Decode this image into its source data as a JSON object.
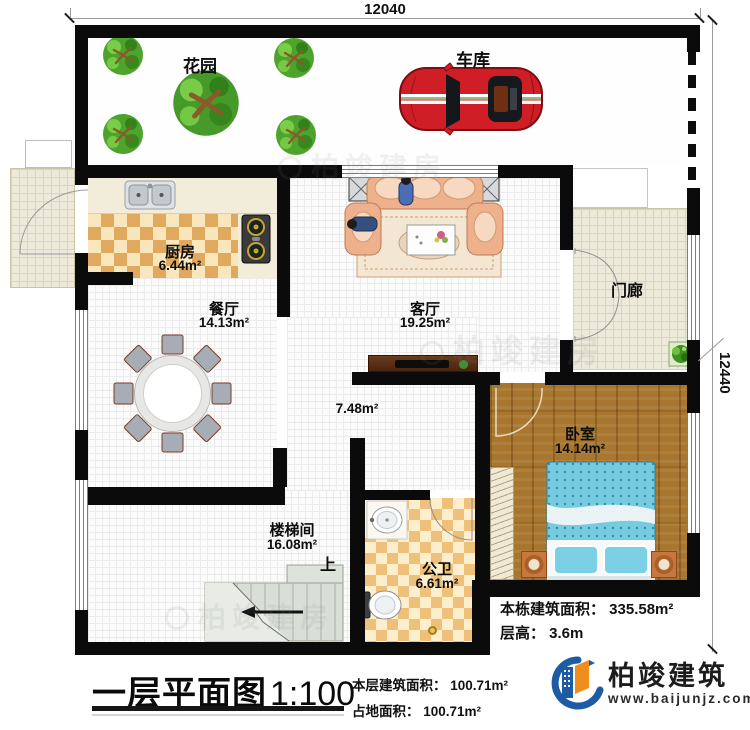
{
  "dimensions": {
    "top": "12040",
    "right": "12440"
  },
  "rooms": {
    "garden": {
      "label": "花园"
    },
    "garage": {
      "label": "车库"
    },
    "kitchen": {
      "label": "厨房",
      "area": "6.44m²"
    },
    "dining": {
      "label": "餐厅",
      "area": "14.13m²"
    },
    "living": {
      "label": "客厅",
      "area": "19.25m²"
    },
    "porch": {
      "label": "门廊"
    },
    "hallway": {
      "area": "7.48m²"
    },
    "bedroom": {
      "label": "卧室",
      "area": "14.14m²"
    },
    "stairwell": {
      "label": "楼梯间",
      "area": "16.08m²",
      "direction": "上"
    },
    "bathroom": {
      "label": "公卫",
      "area": "6.61m²"
    }
  },
  "notes": {
    "building_area": "本栋建筑面积： 335.58m²",
    "floor_height": "层高： 3.6m"
  },
  "titleblock": {
    "title": "一层平面图",
    "scale": "1:100",
    "floor_area": "本层建筑面积： 100.71m²",
    "land_area": "占地面积： 100.71m²"
  },
  "logo": {
    "name": "柏竣建筑",
    "website": "www.baijunjz.com"
  },
  "watermark": "柏竣建房"
}
